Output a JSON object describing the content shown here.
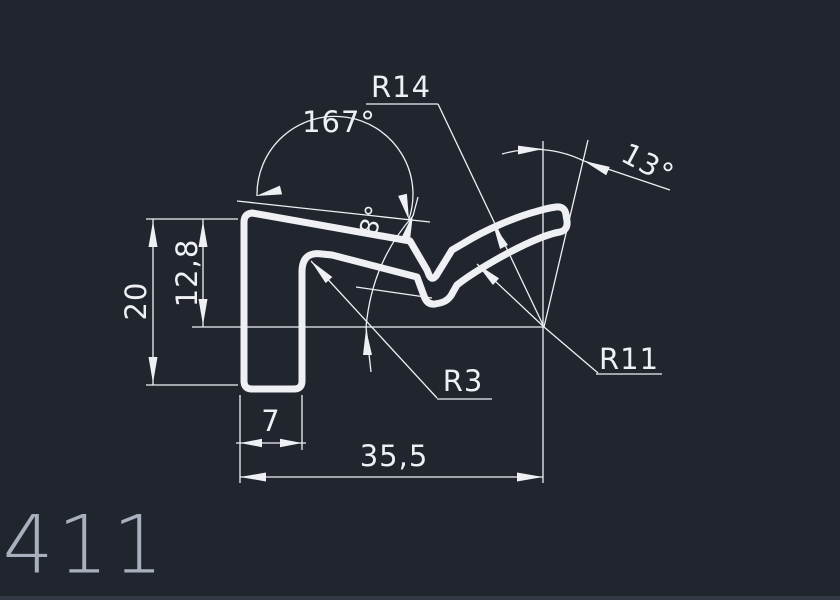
{
  "drawing": {
    "title": "profile-cross-section-drawing",
    "part_number": "411",
    "dimensions": {
      "angle_top": "167°",
      "radius_outer": "R14",
      "angle_tip": "13°",
      "angle_slope": "8°",
      "height_total": "20",
      "height_reference": "12,8",
      "foot_width": "7",
      "total_width": "35,5",
      "radius_fillet": "R3",
      "radius_underside": "R11"
    },
    "colors": {
      "background": "#21252e",
      "line": "#eef0f4",
      "part_number_text": "#a7b0bc"
    }
  }
}
